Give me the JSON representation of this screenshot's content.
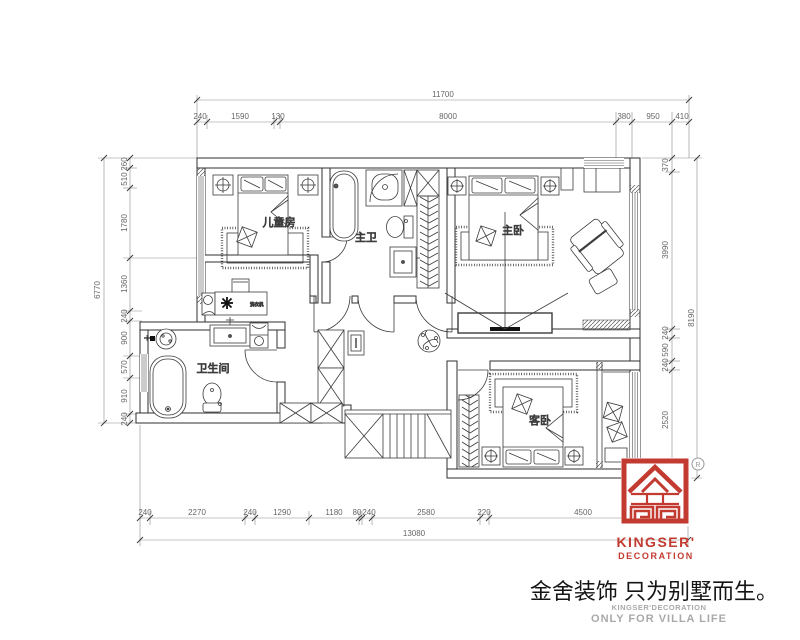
{
  "drawing": {
    "rooms": {
      "children_room": "儿童房",
      "master_bath": "主卫",
      "master_bedroom": "主卧",
      "bathroom": "卫生间",
      "guest_bedroom": "客卧",
      "laundry_unit": "洗衣机"
    },
    "dims": {
      "top": {
        "overall": "11700",
        "segments": [
          "240",
          "1590",
          "130",
          "8000",
          "380",
          "950",
          "410"
        ]
      },
      "left": {
        "overall": "6770",
        "segments": [
          "260",
          "510",
          "1780",
          "1360",
          "240",
          "900",
          "570",
          "910",
          "240"
        ]
      },
      "right": {
        "overall": "8190",
        "segments": [
          "370",
          "3990",
          "240",
          "590",
          "240",
          "2520",
          "240"
        ]
      },
      "bottom": {
        "overall": "13080",
        "segments": [
          "240",
          "2270",
          "240",
          "1290",
          "1180",
          "80",
          "240",
          "2580",
          "220",
          "4500",
          "240"
        ]
      }
    }
  },
  "branding": {
    "logo_text": "KINGSER'",
    "logo_subtext": "DECORATION",
    "reg_r": "R",
    "tagline_cn": "金舍装饰 只为别墅而生。",
    "tagline_en1": "KINGSER'DECORATION",
    "tagline_en2": "ONLY FOR VILLA LIFE",
    "brand_red": "#c23a30",
    "text_grey": "#a9a9a9"
  }
}
